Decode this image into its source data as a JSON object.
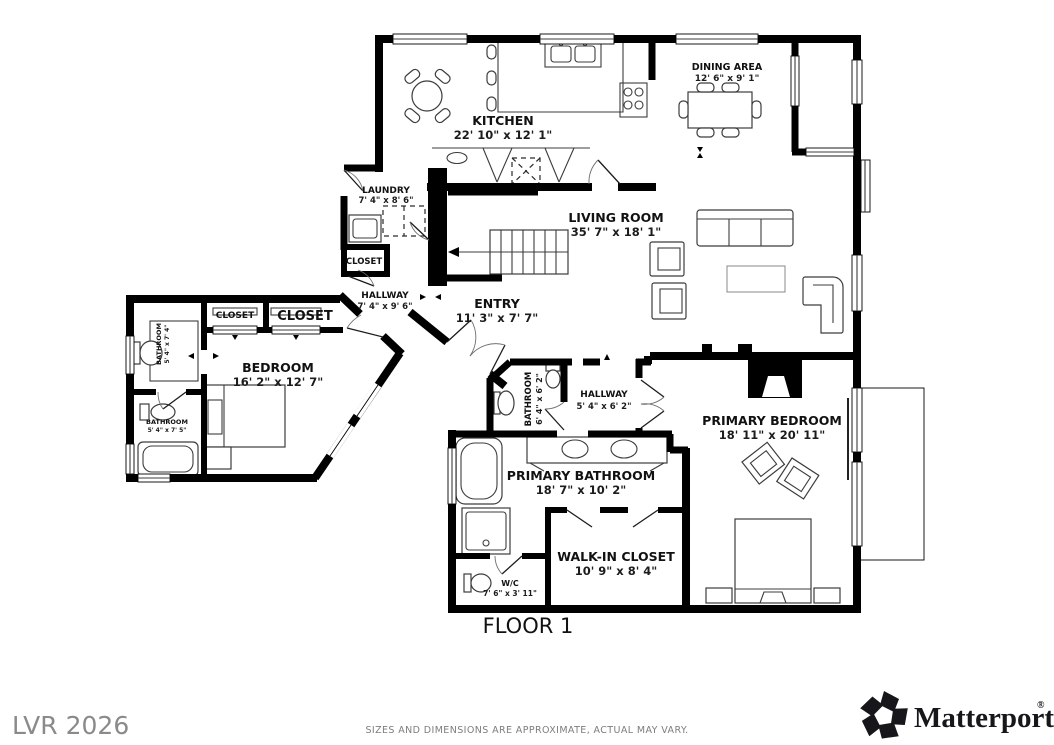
{
  "page": {
    "floor_label": "FLOOR 1",
    "watermark": "LVR 2026",
    "disclaimer": "SIZES AND DIMENSIONS ARE APPROXIMATE, ACTUAL MAY VARY.",
    "brand": {
      "wordmark": "Matterport",
      "registered": "®",
      "logo_icon": "matterport-pinwheel-icon"
    }
  },
  "colors": {
    "wall": "#000000",
    "label": "#111111",
    "muted_text": "#8a8a8a",
    "background": "#ffffff"
  },
  "rooms": {
    "kitchen": {
      "name": "KITCHEN",
      "dims": "22' 10\" x 12' 1\""
    },
    "dining": {
      "name": "DINING AREA",
      "dims": "12' 6\" x 9' 1\""
    },
    "living": {
      "name": "LIVING ROOM",
      "dims": "35' 7\" x 18' 1\""
    },
    "laundry": {
      "name": "LAUNDRY",
      "dims": "7' 4\" x 8' 6\""
    },
    "closet_small": {
      "name": "CLOSET"
    },
    "hallway_west": {
      "name": "HALLWAY",
      "dims": "7' 4\" x 9' 6\""
    },
    "entry": {
      "name": "ENTRY",
      "dims": "11' 3\" x 7' 7\""
    },
    "closet_a": {
      "name": "CLOSET"
    },
    "closet_b": {
      "name": "CLOSET"
    },
    "bedroom": {
      "name": "BEDROOM",
      "dims": "16' 2\" x 12' 7\""
    },
    "bath_upper": {
      "name": "BATHROOM",
      "dims": "5' 4\" x 7' 4\""
    },
    "bath_lower": {
      "name": "BATHROOM",
      "dims": "5' 4\" x 7' 5\""
    },
    "bath_mid": {
      "name": "BATHROOM",
      "dims": "6' 4\" x 6' 2\""
    },
    "hallway_mid": {
      "name": "HALLWAY",
      "dims": "5' 4\" x 6' 2\""
    },
    "primary_bedroom": {
      "name": "PRIMARY BEDROOM",
      "dims": "18' 11\" x 20' 11\""
    },
    "primary_bathroom": {
      "name": "PRIMARY BATHROOM",
      "dims": "18' 7\" x 10' 2\""
    },
    "walk_in_closet": {
      "name": "WALK-IN CLOSET",
      "dims": "10' 9\" x 8' 4\""
    },
    "wc": {
      "name": "W/C",
      "dims": "7' 6\" x 3' 11\""
    }
  }
}
